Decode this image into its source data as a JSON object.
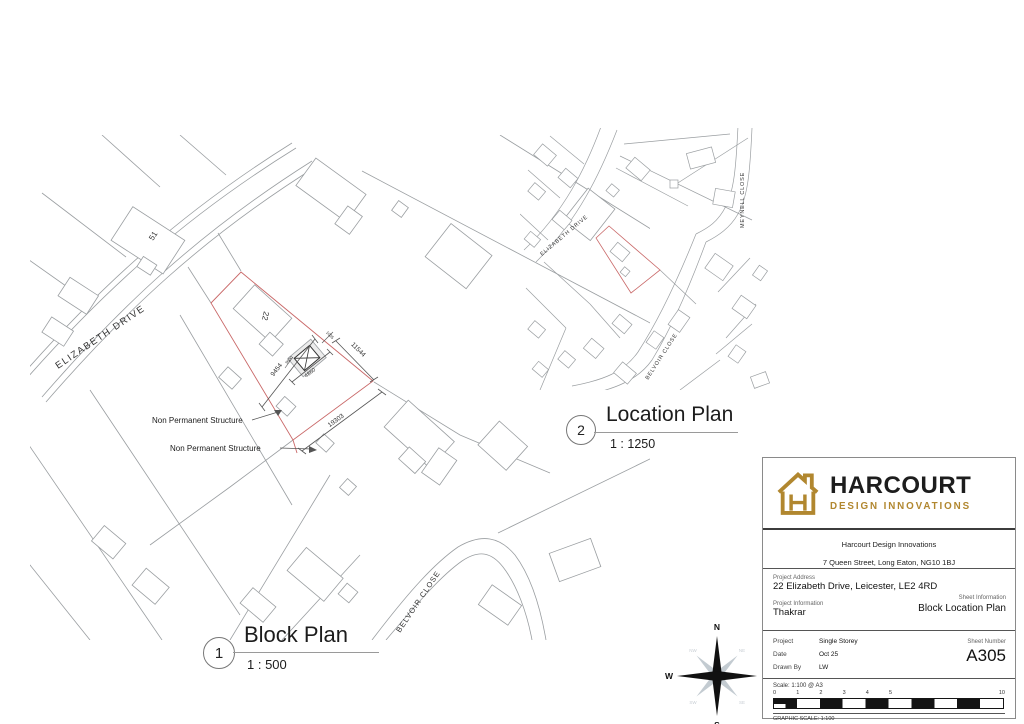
{
  "block_plan": {
    "number": "1",
    "title": "Block Plan",
    "scale": "1 : 500",
    "labels": {
      "street_elizabeth": "ELIZABETH DRIVE",
      "street_belvoir": "BELVOIR CLOSE",
      "house_51": "51",
      "house_22": "22",
      "non_permanent": [
        "Non Permanent Structure",
        "Non Permanent Structure"
      ]
    },
    "dimensions": {
      "left": "9454",
      "right": "11544",
      "bottom": "19303",
      "structure_width": "4860",
      "structure_gap": "1035",
      "structure_depth": "3600"
    },
    "colors": {
      "site_boundary": "#c96868",
      "linework": "#9a9ea1"
    }
  },
  "location_plan": {
    "number": "2",
    "title": "Location Plan",
    "scale": "1 : 1250",
    "labels": {
      "street_elizabeth": "ELIZABETH DRIVE",
      "street_meynell": "MEYNELL CLOSE",
      "street_belvoir": "BELVOIR CLOSE"
    }
  },
  "compass": {
    "cardinal": [
      "N",
      "E",
      "S",
      "W"
    ],
    "intercardinal": [
      "NW",
      "NE",
      "SW",
      "SE"
    ]
  },
  "title_block": {
    "logo": {
      "name": "HARCOURT",
      "tagline": "DESIGN INNOVATIONS",
      "gold": "#b1872f"
    },
    "company_name": "Harcourt Design Innovations",
    "company_address": "7 Queen Street, Long Eaton, NG10 1BJ",
    "project_address_label": "Project Address",
    "project_address": "22 Elizabeth Drive, Leicester, LE2 4RD",
    "sheet_information_label": "Sheet Information",
    "sheet_information": "Block Location Plan",
    "project_information_label": "Project Information",
    "project_information": "Thakrar",
    "project_label": "Project",
    "project_value": "Single Storey",
    "date_label": "Date",
    "date_value": "Oct 25",
    "drawn_by_label": "Drawn By",
    "drawn_by_value": "LW",
    "sheet_number_label": "Sheet Number",
    "sheet_number": "A305",
    "scale_note": "Scale: 1:100 @ A3",
    "scale_ticks": [
      "0",
      "1",
      "2",
      "3",
      "4",
      "5",
      "10"
    ],
    "graphic_scale_label": "GRAPHIC SCALE: 1:100"
  }
}
